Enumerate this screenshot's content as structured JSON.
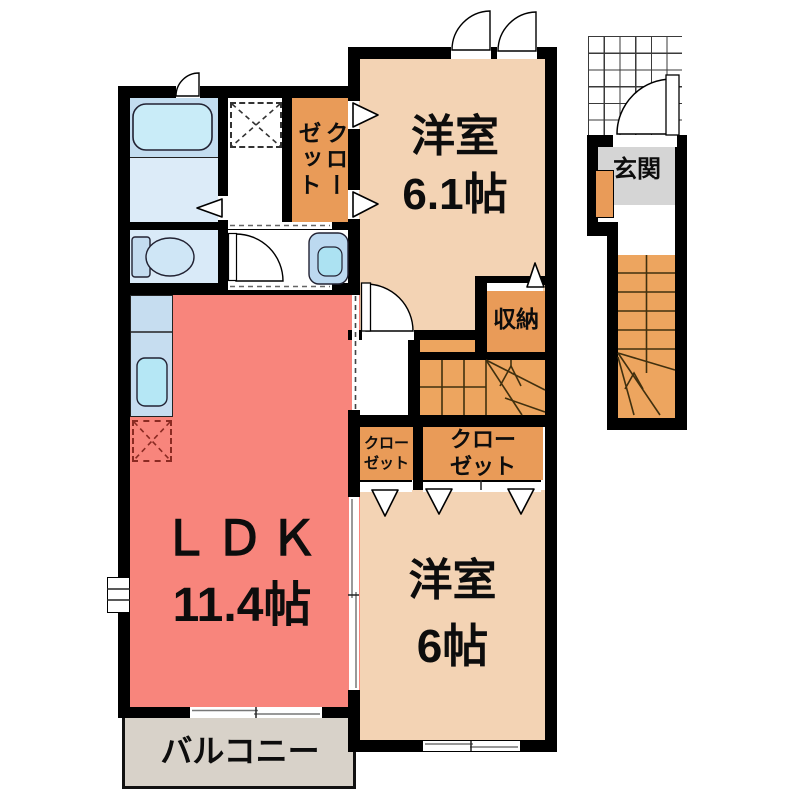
{
  "title": "2F apartment floor plan",
  "rooms": {
    "western_room_1": {
      "label": "洋室",
      "size": "6.1帖"
    },
    "western_room_2": {
      "label": "洋室",
      "size": "6帖"
    },
    "ldk": {
      "label": "ＬＤＫ",
      "size": "11.4帖"
    },
    "balcony": {
      "label": "バルコニー"
    },
    "entrance": {
      "label": "玄関"
    },
    "storage": {
      "label": "収納"
    },
    "closet_vertical": {
      "label": "クローゼット"
    },
    "closet_small": {
      "label": "クロー\nゼット"
    },
    "closet_large": {
      "label": "クロー\nゼット"
    }
  },
  "fixtures": [
    "bathtub",
    "toilet",
    "wash-basin",
    "kitchen-sink",
    "washer-space",
    "refrigerator-space",
    "indoor-staircase",
    "outdoor-staircase"
  ],
  "colors": {
    "room_tan": "#f3d3b4",
    "ldk_salmon": "#f8857c",
    "closet_orange": "#e99b58",
    "stairs_orange": "#eda55f",
    "bath_blue": "#c3ddf0",
    "water_blue": "#d9eaf8",
    "kitchen_blue": "#c6ddf0",
    "tub_cyan": "#c9ecf8",
    "genkan_gray": "#d5d5d5",
    "balcony_beige": "#d8d2c9",
    "wall": "#000000"
  }
}
